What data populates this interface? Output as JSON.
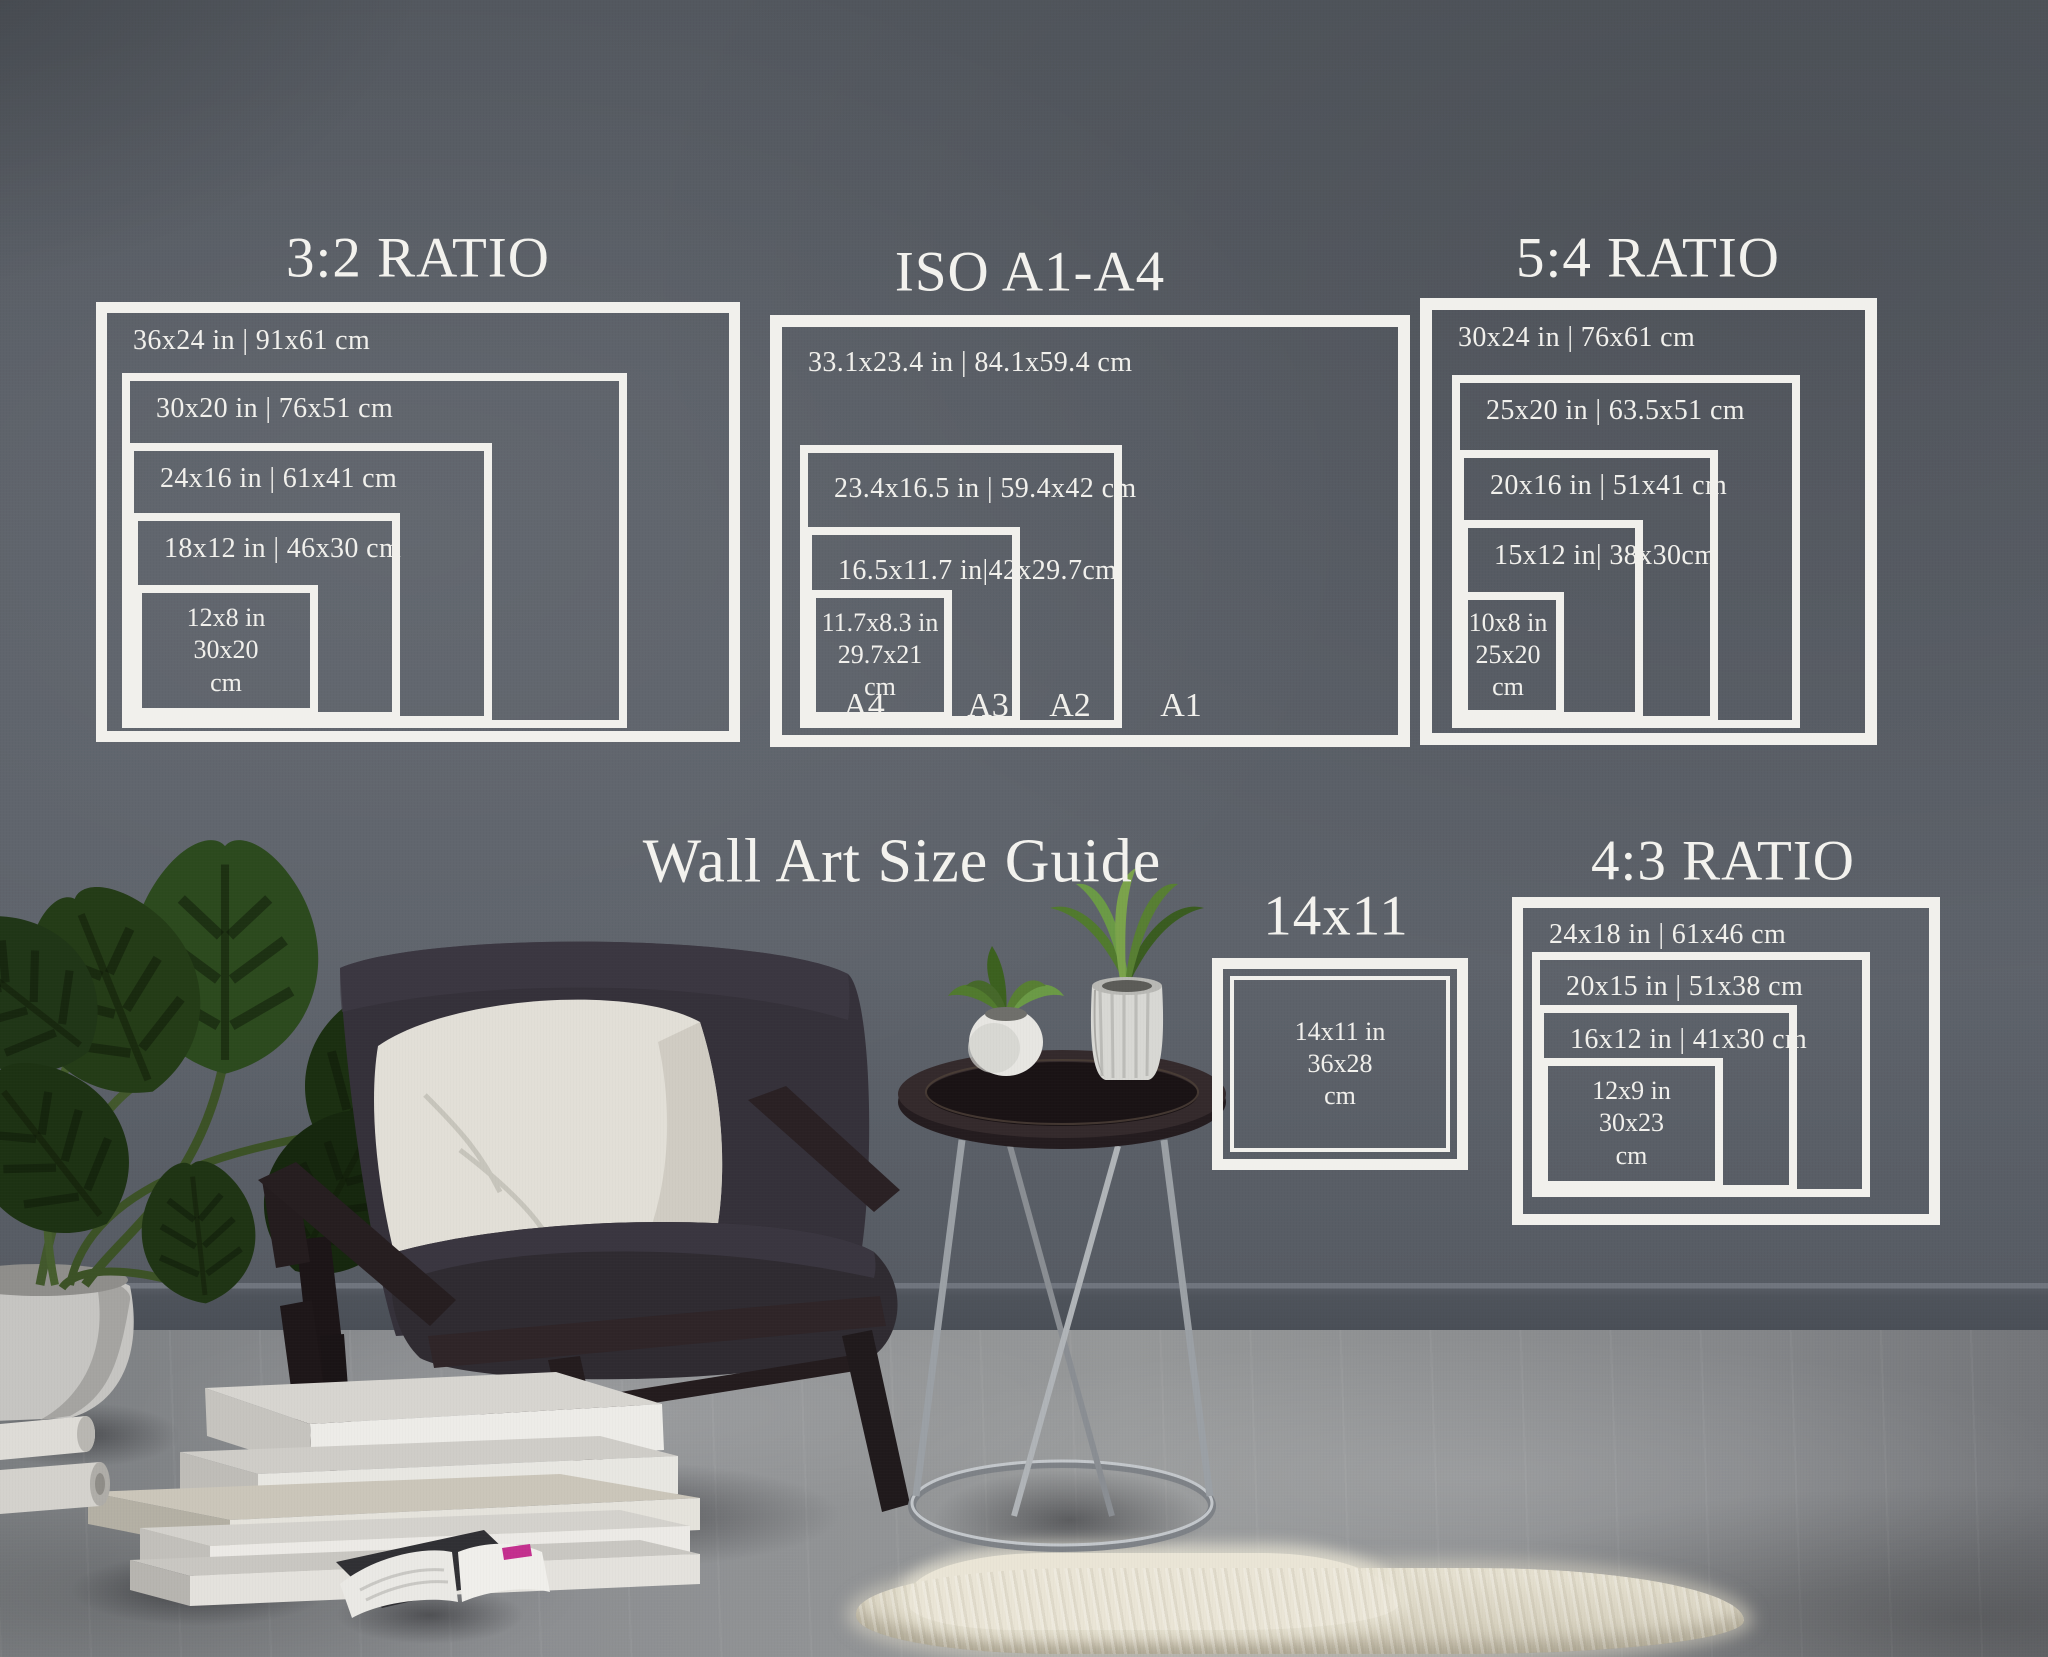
{
  "main_title": "Wall Art Size Guide",
  "groups": [
    {
      "id": "ratio-3-2",
      "title": "3:2 RATIO",
      "rects": [
        {
          "label": "36x24 in | 91x61 cm"
        },
        {
          "label": "30x20 in | 76x51 cm"
        },
        {
          "label": "24x16 in | 61x41 cm"
        },
        {
          "label": "18x12 in | 46x30 cm"
        },
        {
          "label_lines": [
            "12x8 in",
            "30x20",
            "cm"
          ]
        }
      ]
    },
    {
      "id": "iso-a1-a4",
      "title": "ISO A1-A4",
      "rects": [
        {
          "label": "33.1x23.4 in | 84.1x59.4 cm",
          "corner_label": "A1"
        },
        {
          "label": "23.4x16.5 in | 59.4x42 cm",
          "corner_label": "A2"
        },
        {
          "label": "16.5x11.7 in|42x29.7cm",
          "corner_label": "A3"
        },
        {
          "label_lines": [
            "11.7x8.3 in",
            "29.7x21",
            "cm"
          ],
          "corner_label": "A4"
        }
      ]
    },
    {
      "id": "ratio-5-4",
      "title": "5:4 RATIO",
      "rects": [
        {
          "label": "30x24 in | 76x61 cm"
        },
        {
          "label": "25x20 in | 63.5x51 cm"
        },
        {
          "label": "20x16 in | 51x41 cm"
        },
        {
          "label": "15x12 in| 38x30cm"
        },
        {
          "label_lines": [
            "10x8 in",
            "25x20",
            "cm"
          ]
        }
      ]
    },
    {
      "id": "size-14x11",
      "title": "14x11",
      "rects": [
        {
          "label_lines": [
            "14x11 in",
            "36x28",
            "cm"
          ]
        }
      ]
    },
    {
      "id": "ratio-4-3",
      "title": "4:3 RATIO",
      "rects": [
        {
          "label": "24x18 in | 61x46 cm"
        },
        {
          "label": "20x15 in | 51x38 cm"
        },
        {
          "label": "16x12 in | 41x30 cm"
        },
        {
          "label_lines": [
            "12x9 in",
            "30x23",
            "cm"
          ]
        }
      ]
    }
  ],
  "colors": {
    "overlay_white": "#f1f0ec",
    "wall": "#5a5f67",
    "floor": "#8f9193",
    "accent_pink": "#c4308e"
  }
}
